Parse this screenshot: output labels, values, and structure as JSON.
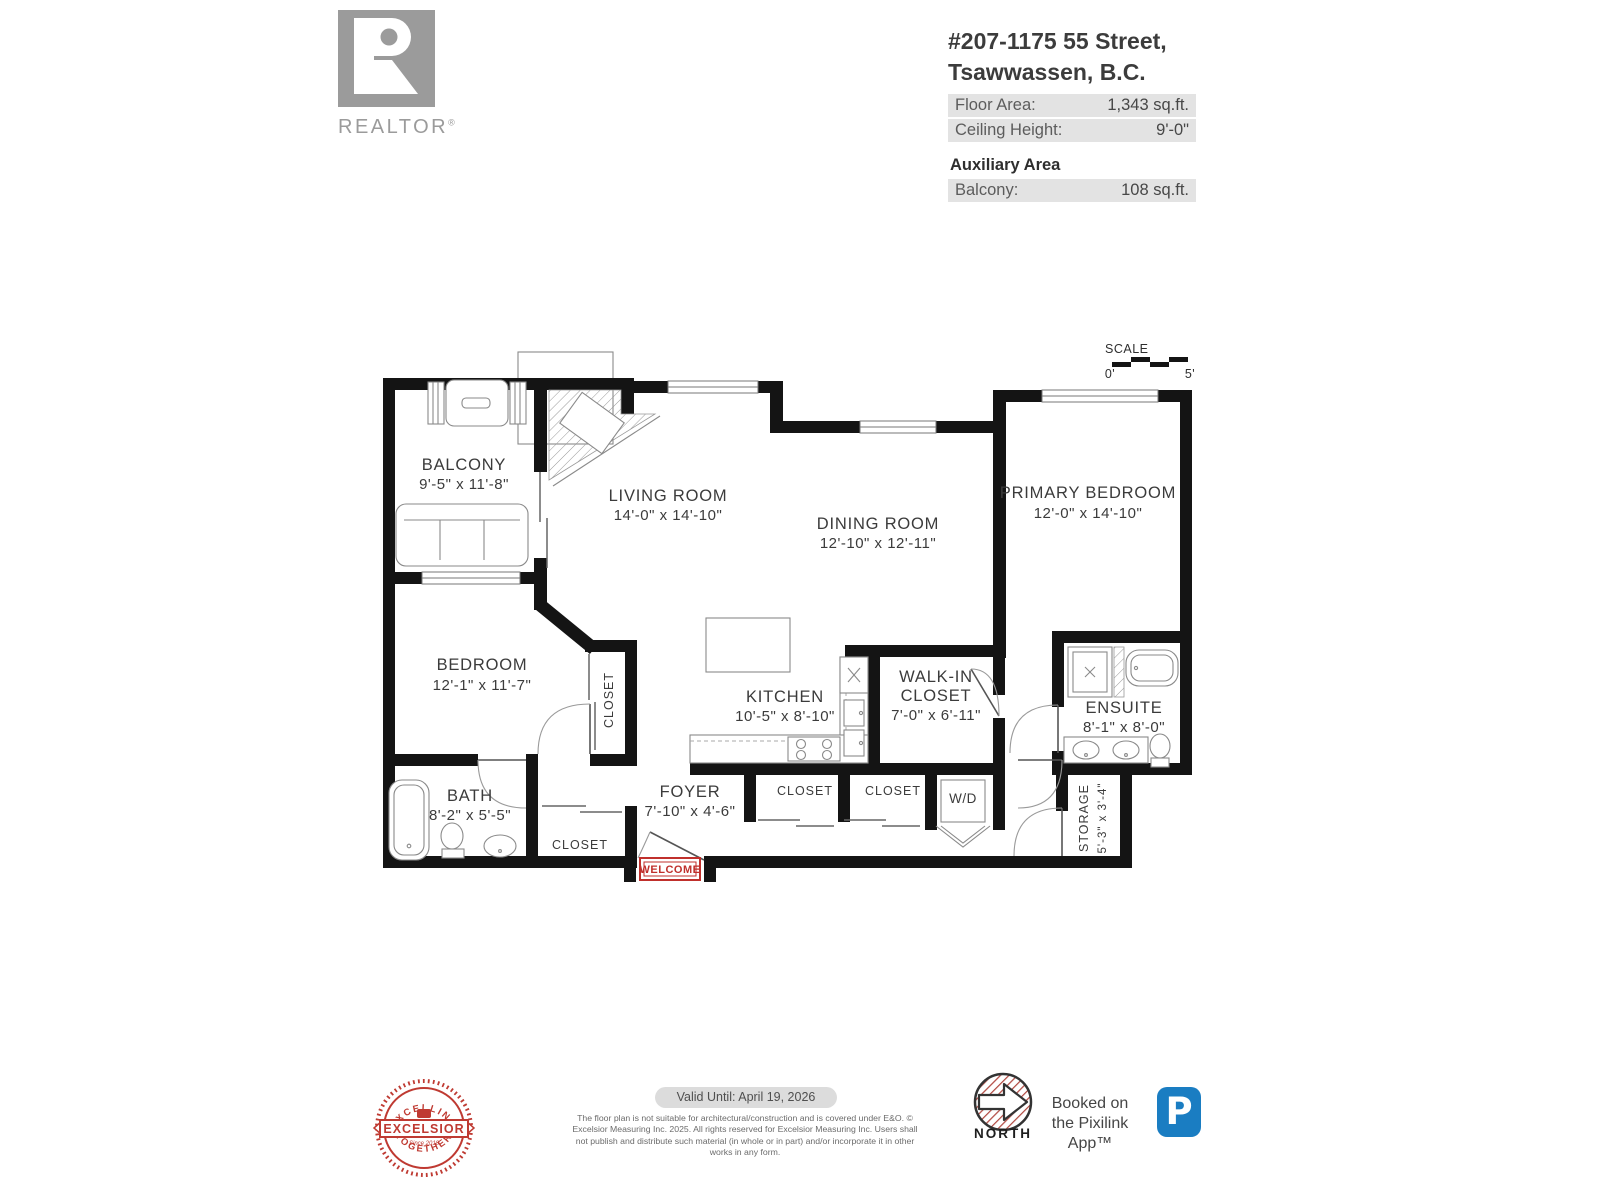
{
  "logo": {
    "name": "REALTOR",
    "reg": "®"
  },
  "header": {
    "address_line1": "#207-1175 55 Street,",
    "address_line2": "Tsawwassen, B.C.",
    "rows": [
      {
        "label": "Floor Area:",
        "value": "1,343 sq.ft."
      },
      {
        "label": "Ceiling Height:",
        "value": "9'-0\""
      }
    ],
    "aux_title": "Auxiliary Area",
    "aux_rows": [
      {
        "label": "Balcony:",
        "value": "108 sq.ft."
      }
    ]
  },
  "scale": {
    "title": "SCALE",
    "zero": "0'",
    "five": "5'"
  },
  "plan": {
    "balcony": {
      "name": "BALCONY",
      "dims": "9'-5\" x 11'-8\""
    },
    "living": {
      "name": "LIVING ROOM",
      "dims": "14'-0\" x 14'-10\""
    },
    "dining": {
      "name": "DINING ROOM",
      "dims": "12'-10\" x 12'-11\""
    },
    "primary": {
      "name": "PRIMARY BEDROOM",
      "dims": "12'-0\" x 14'-10\""
    },
    "bedroom": {
      "name": "BEDROOM",
      "dims": "12'-1\" x 11'-7\""
    },
    "kitchen": {
      "name": "KITCHEN",
      "dims": "10'-5\" x 8'-10\""
    },
    "walkin": {
      "line1": "WALK-IN",
      "line2": "CLOSET",
      "dims": "7'-0\" x 6'-11\""
    },
    "ensuite": {
      "name": "ENSUITE",
      "dims": "8'-1\" x 8'-0\""
    },
    "bath": {
      "name": "BATH",
      "dims": "8'-2\" x 5'-5\""
    },
    "foyer": {
      "name": "FOYER",
      "dims": "7'-10\" x 4'-6\""
    },
    "storage": {
      "name": "STORAGE",
      "dims": "5'-3\" x 3'-4\""
    },
    "closet_vertical": "CLOSET",
    "closet_bottom": "CLOSET",
    "closet_a": "CLOSET",
    "closet_b": "CLOSET",
    "wd": "W/D",
    "welcome": "WELCOME"
  },
  "footer": {
    "badge": {
      "top": "EXCELLING",
      "middle": "EXCELSIOR",
      "bottom": "TOGETHER",
      "since": "Since 2018"
    },
    "valid": "Valid Until: April 19, 2026",
    "disclaimer": "The floor plan is not suitable for architectural/construction and is covered under E&O. © Excelsior Measuring Inc. 2025. All rights reserved for Excelsior Measuring Inc. Users shall not publish and distribute such material (in whole or in part) and/or incorporate it in other works in any form.",
    "north": "NORTH",
    "booked_line1": "Booked on",
    "booked_line2": "the Pixilink App™",
    "app_letter": "P"
  },
  "colors": {
    "red": "#c0302c",
    "blue": "#1a7dc2",
    "logo_gray": "#9b9b9b",
    "wall": "#141414"
  }
}
